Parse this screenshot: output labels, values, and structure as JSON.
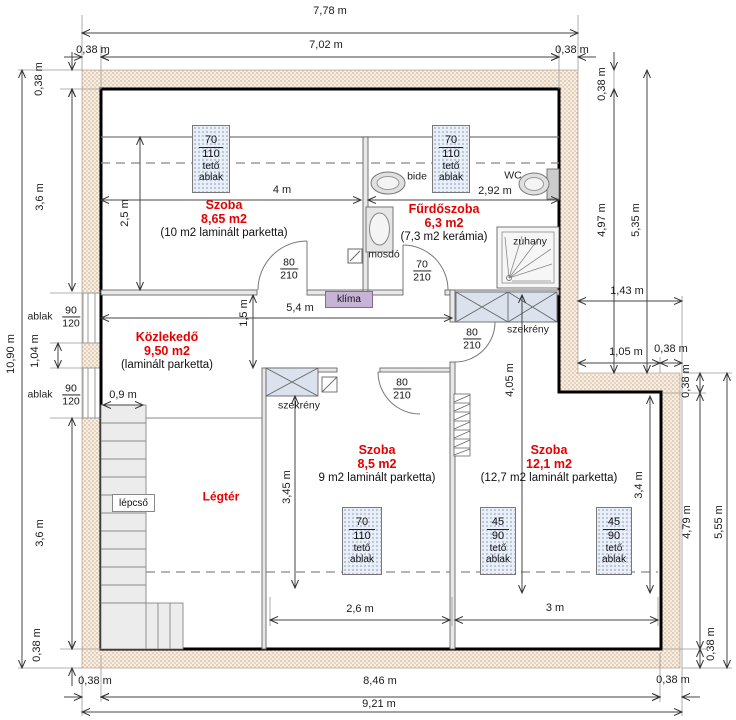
{
  "title": "Tetőtér alaprajz",
  "colors": {
    "accent_red": "#e60000",
    "wall_hatch_bg": "#f6efe3",
    "wall_hatch_dot": "#c89a78",
    "window_fill": "#e9eef7",
    "cabinet_fill": "#dbe2ee",
    "klima_fill": "#c6b4d6",
    "stair_fill": "#ececec"
  },
  "rooms": {
    "szoba1": {
      "name": "Szoba",
      "area": "8,65 m2",
      "note": "(10 m2 laminált parketta)"
    },
    "furdoszoba": {
      "name": "Fűrdőszoba",
      "area": "6,3 m2",
      "note": "(7,3 m2 kerámia)"
    },
    "kozlekedo": {
      "name": "Közlekedő",
      "area": "9,50 m2",
      "note": "(laminált parketta)"
    },
    "szoba2": {
      "name": "Szoba",
      "area": "8,5 m2",
      "note": "9 m2 laminált parketta)"
    },
    "szoba3": {
      "name": "Szoba",
      "area": "12,1 m2",
      "note": "(12,7 m2 laminált parketta)"
    },
    "legter": {
      "name": "Légtér"
    }
  },
  "fixtures": {
    "bide": "bide",
    "wc": "WC",
    "mosdo": "mosdó",
    "zuhany": "zuhany",
    "szekreny": "szekrény",
    "klima": "klíma",
    "lepcso": "lépcső"
  },
  "windows": {
    "side": {
      "label": "ablak",
      "w": "90",
      "h": "120"
    },
    "roof70": {
      "w": "70",
      "h": "110",
      "type1": "tető",
      "type2": "ablak"
    },
    "roof45": {
      "w": "45",
      "h": "90",
      "type1": "tető",
      "type2": "ablak"
    }
  },
  "doors": {
    "d80": {
      "w": "80",
      "h": "210"
    },
    "d70": {
      "w": "70",
      "h": "210"
    }
  },
  "dims": {
    "m778": "7,78 m",
    "m702": "7,02 m",
    "m038": "0,38 m",
    "m36": "3,6 m",
    "m104": "1,04 m",
    "m1090": "10,90 m",
    "m497": "4,97 m",
    "m535": "5,35 m",
    "m143": "1,43 m",
    "m105": "1,05 m",
    "m479": "4,79 m",
    "m555": "5,55 m",
    "m846": "8,46 m",
    "m921": "9,21 m",
    "m4": "4 m",
    "m292": "2,92 m",
    "m25": "2,5 m",
    "m54": "5,4 m",
    "m15": "1,5 m",
    "m09": "0,9 m",
    "m345": "3,45 m",
    "m405": "4,05 m",
    "m34": "3,4 m",
    "m26": "2,6 m",
    "m3": "3 m"
  }
}
